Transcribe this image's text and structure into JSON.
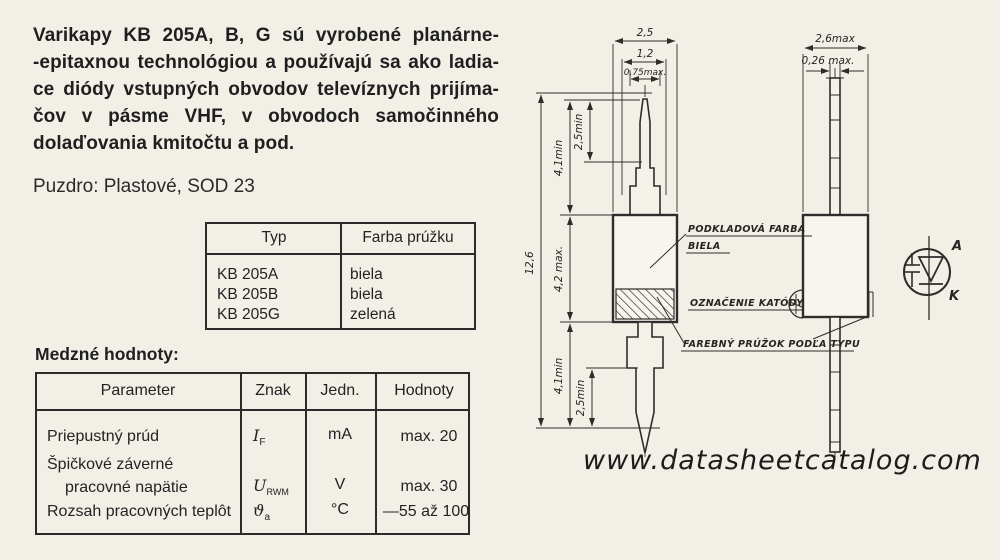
{
  "intro": {
    "lines": [
      "Varikapy KB 205A, B, G sú vyrobené planárne-",
      "-epitaxnou technológiou a používajú sa ako ladia-",
      "ce diódy vstupných obvodov televíznych prijíma-",
      "čov v pásme VHF, v obvodoch samočinného",
      "dolaďovania kmitočtu a pod."
    ]
  },
  "package_line": "Puzdro: Plastové, SOD 23",
  "type_table": {
    "headers": {
      "typ": "Typ",
      "farba": "Farba prúžku"
    },
    "rows": [
      {
        "typ": "KB 205A",
        "farba": "biela"
      },
      {
        "typ": "KB 205B",
        "farba": "biela"
      },
      {
        "typ": "KB 205G",
        "farba": "zelená"
      }
    ]
  },
  "limits_table": {
    "heading": "Medzné hodnoty:",
    "headers": {
      "parameter": "Parameter",
      "znak": "Znak",
      "jedn": "Jedn.",
      "hodnoty": "Hodnoty"
    },
    "rows": [
      {
        "parameter": "Priepustný prúd",
        "znak_base": "I",
        "znak_sub": "F",
        "jedn": "mA",
        "hodnoty": "max. 20"
      },
      {
        "parameter_line1": "Špičkové záverné",
        "parameter_line2": "pracovné napätie",
        "znak_base": "U",
        "znak_sub": "RWM",
        "jedn": "V",
        "hodnoty": "max. 30"
      },
      {
        "parameter": "Rozsah pracovných teplôt",
        "znak_base": "ϑ",
        "znak_sub": "a",
        "jedn": "°C",
        "hodnoty": "—55 až 100"
      }
    ]
  },
  "drawing": {
    "front_dims": {
      "w25": "2,5",
      "w12": "1,2",
      "w075": "0,75max.",
      "h126": "12,6",
      "h41a": "4,1min",
      "h42": "4,2 max.",
      "h41b": "4,1min",
      "h25a": "2,5min",
      "h25b": "2,5min"
    },
    "side_dims": {
      "w26": "2,6max",
      "w026": "0,26 max."
    },
    "labels": {
      "base_color_1": "PODKLADOVÁ FARBA",
      "base_color_2": "BIELA",
      "cathode_mark": "OZNAČENIE KATÓDY",
      "stripe": "FAREBNÝ PRÚŽOK PODĽA TYPU"
    },
    "symbol": {
      "anode": "A",
      "cathode": "K"
    }
  },
  "watermark": "www.datasheetcatalog.com"
}
